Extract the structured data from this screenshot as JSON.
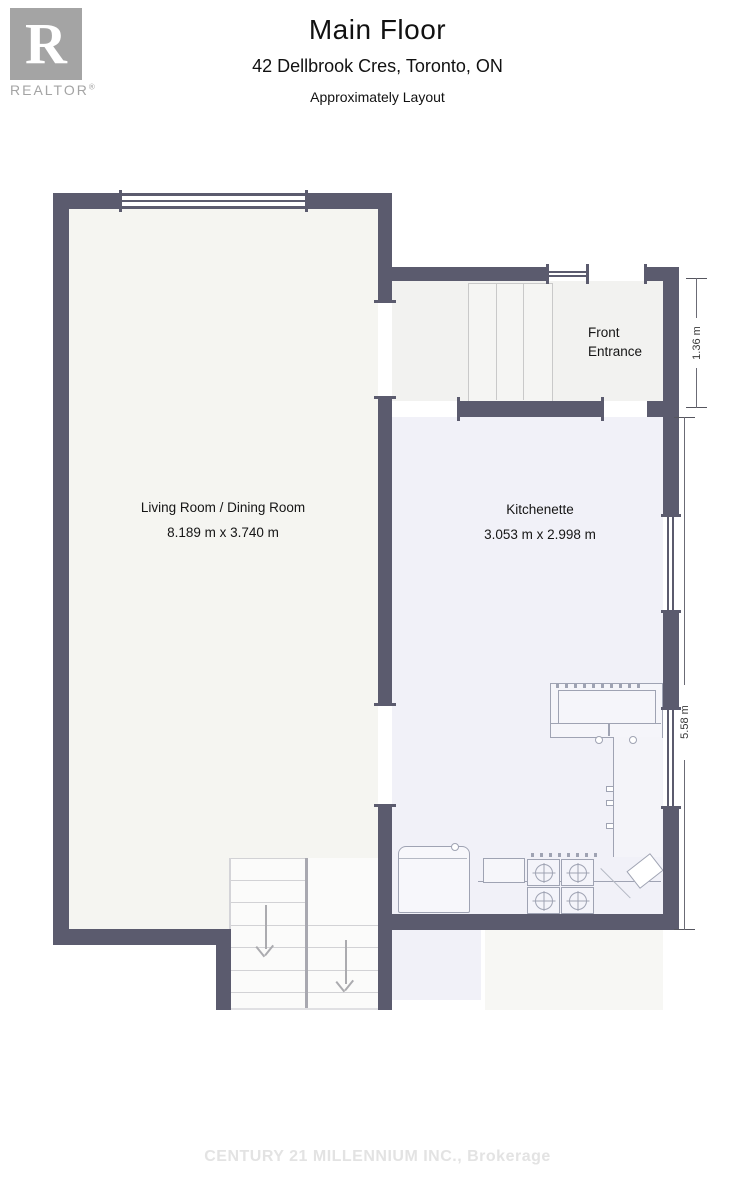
{
  "header": {
    "logo": {
      "letter": "R",
      "brand": "REALTOR",
      "registered": "®"
    },
    "title": "Main Floor",
    "address": "42 Dellbrook Cres, Toronto, ON",
    "subtitle": "Approximately Layout"
  },
  "rooms": [
    {
      "id": "living-dining",
      "name": "Living Room / Dining Room",
      "dims": "8.189 m x 3.740 m"
    },
    {
      "id": "kitchenette",
      "name": "Kitchenette",
      "dims": "3.053 m x 2.998 m"
    },
    {
      "id": "front-entrance",
      "name_line1": "Front",
      "name_line2": "Entrance"
    }
  ],
  "dimensions": [
    {
      "edge": "front-entrance-right",
      "label": "1.36 m"
    },
    {
      "edge": "kitchenette-right",
      "label": "5.58 m"
    }
  ],
  "footer": {
    "watermark": "CENTURY 21 MILLENNIUM INC., Brokerage"
  },
  "colors": {
    "wall": "#5b5b6e",
    "living_floor": "#f5f5f1",
    "kitchenette_floor": "#f1f1f8",
    "entrance_floor": "#f2f2f0",
    "fixture_stroke": "#9fa3b3",
    "logo_gray": "#a4a4a4",
    "watermark_gray": "#e3e3e3"
  }
}
